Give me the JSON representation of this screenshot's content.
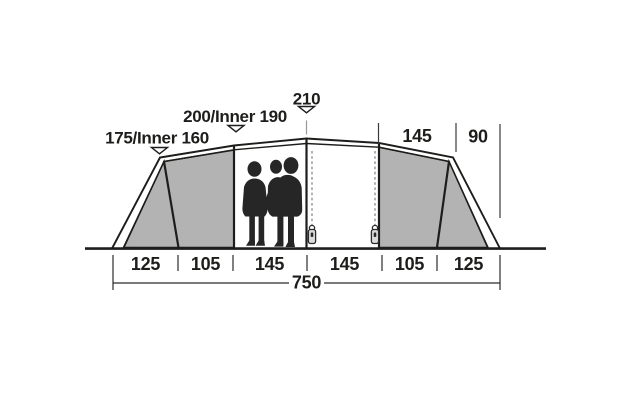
{
  "labels": {
    "height_front": "175/Inner 160",
    "height_mid": "200/Inner 190",
    "height_peak": "210",
    "width_bedroom_top": "145",
    "width_porch_top": "90",
    "total_length": "750"
  },
  "bottom_segments": [
    "125",
    "105",
    "145",
    "145",
    "105",
    "125"
  ],
  "colors": {
    "line": "#1d1d1b",
    "panel_gray": "#b3b3b3",
    "marker_fill": "#ffffff",
    "silhouette": "#262626",
    "dash_gray": "#808080",
    "zipper_pull_fill": "#dcdcdc",
    "background": "#ffffff"
  }
}
